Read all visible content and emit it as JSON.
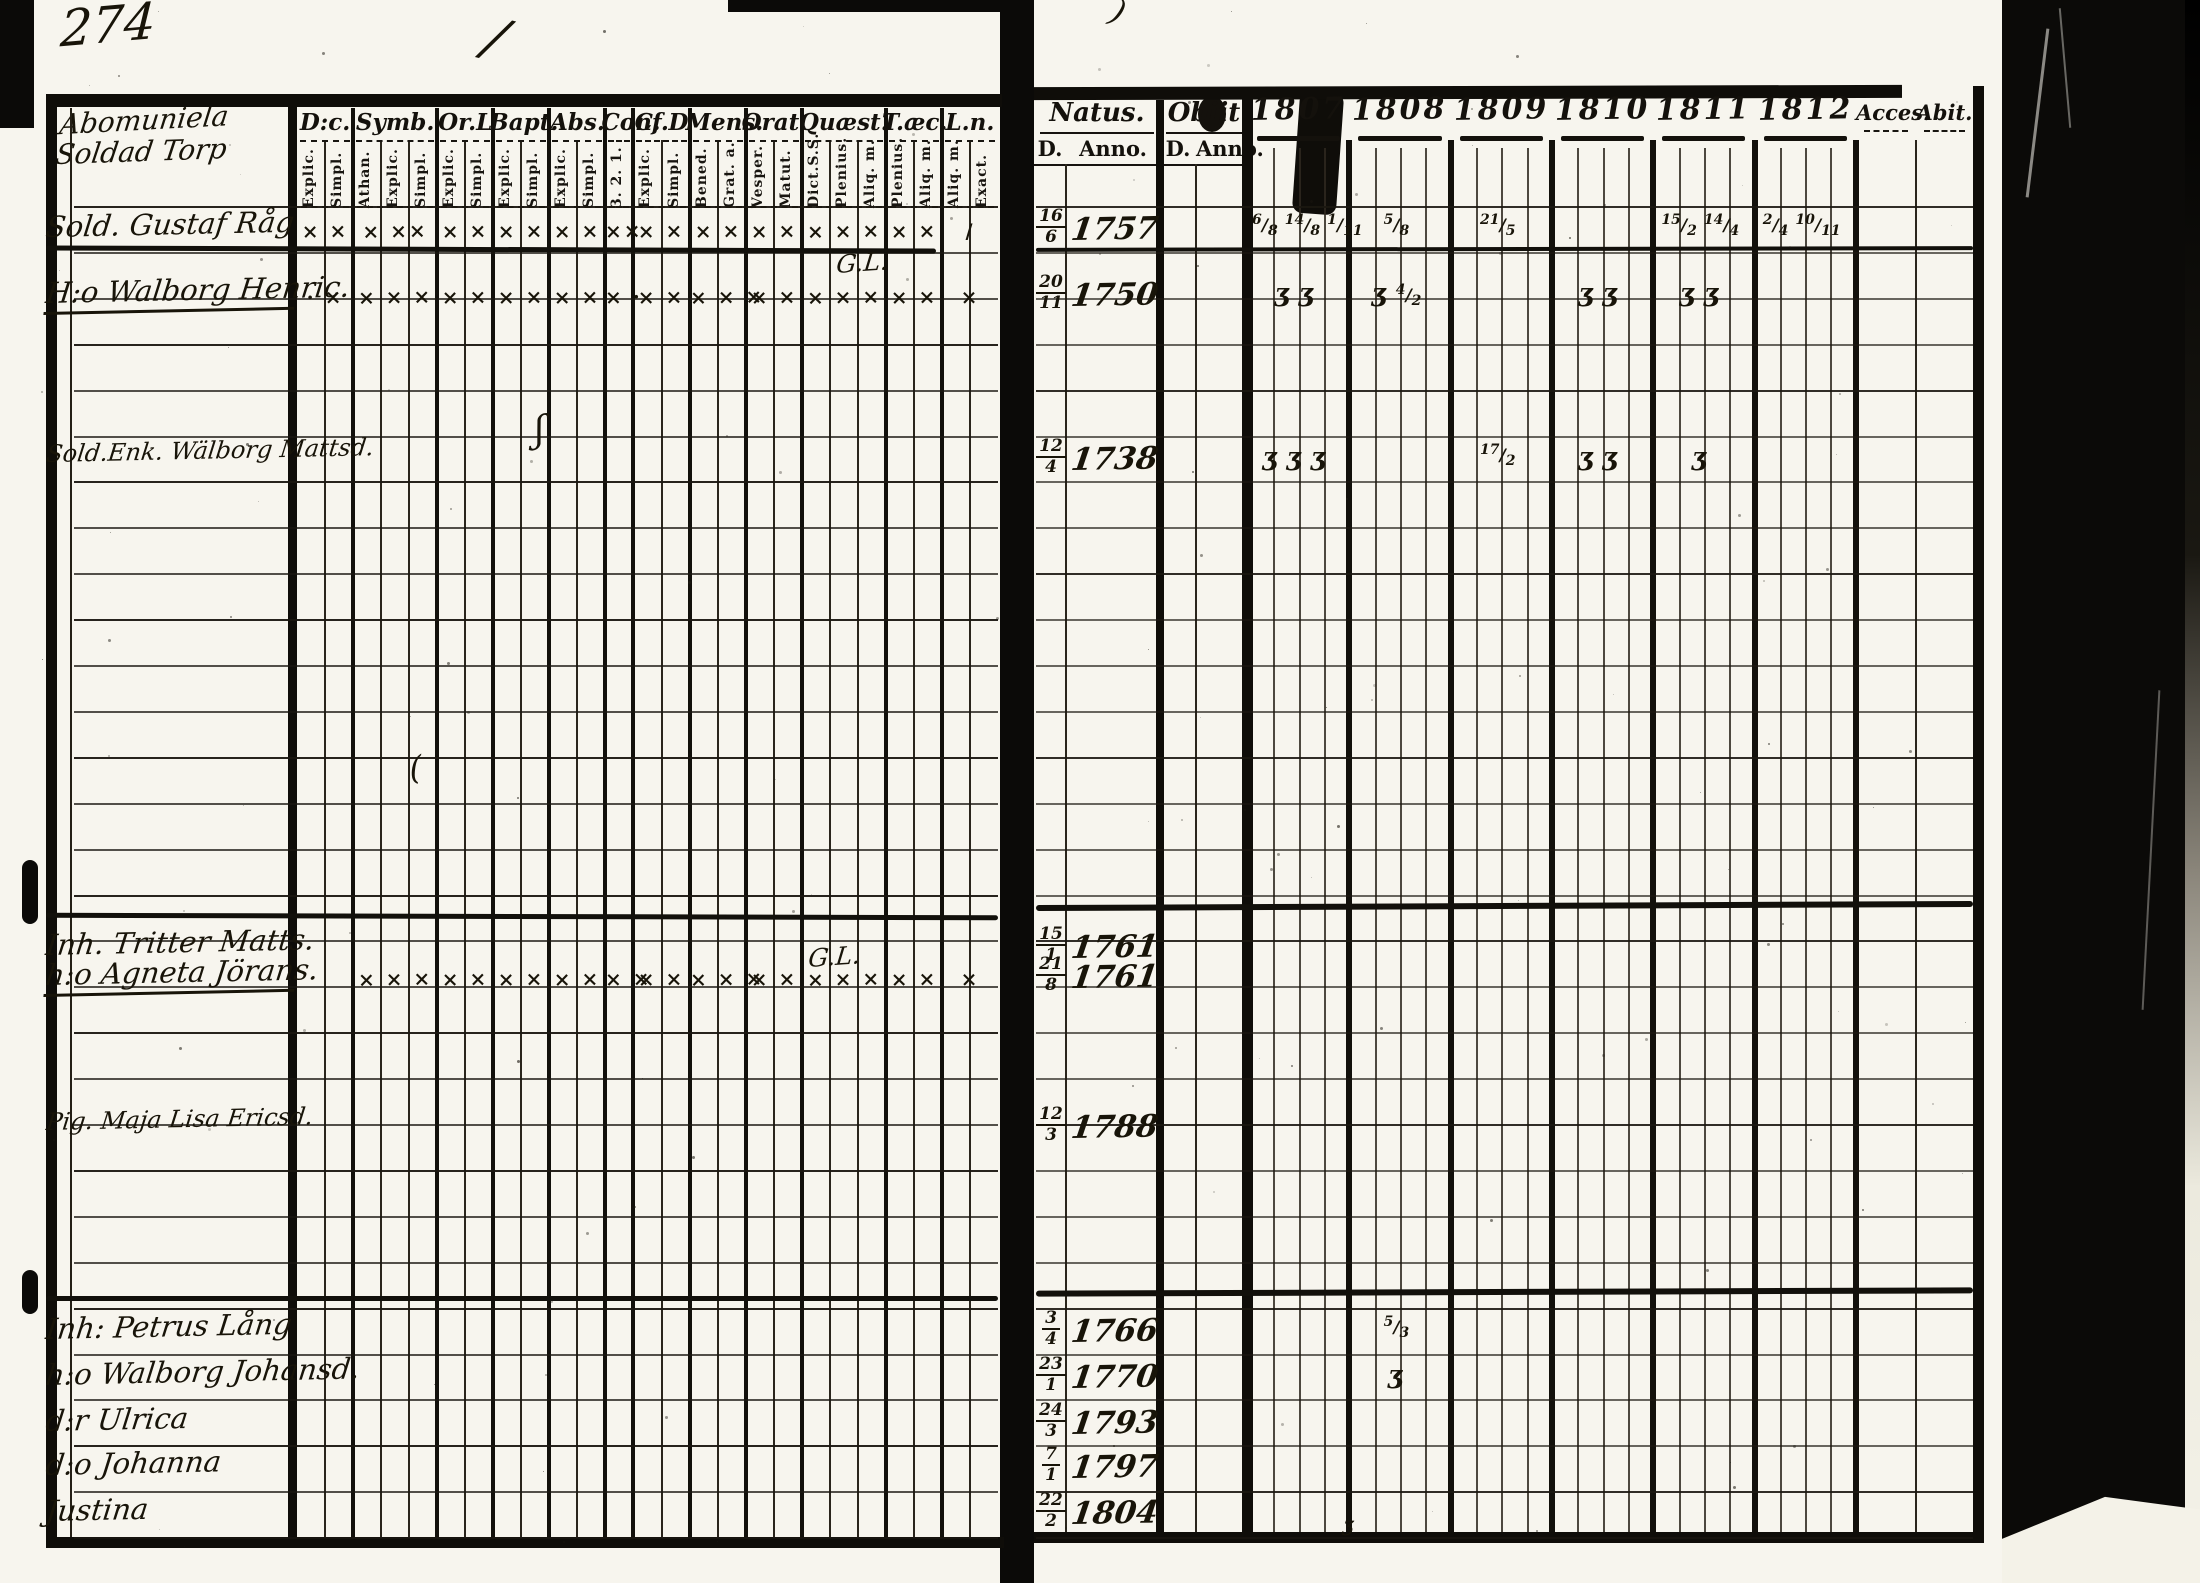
{
  "page_number": "274",
  "left_page": {
    "heading_lines": [
      "Abomuniela",
      "Soldad Torp"
    ],
    "column_groups": [
      {
        "label": "D:c.",
        "subs": [
          "Explic.",
          "Simpl."
        ]
      },
      {
        "label": "Symb.",
        "subs": [
          "Athan.",
          "Explic.",
          "Simpl."
        ]
      },
      {
        "label": "Or.L",
        "subs": [
          "Explic.",
          "Simpl."
        ]
      },
      {
        "label": "Bapt.",
        "subs": [
          "Explic.",
          "Simpl."
        ]
      },
      {
        "label": "Abs.",
        "subs": [
          "Explic.",
          "Simpl."
        ]
      },
      {
        "label": "Conf.",
        "subs": [
          "3. 2. 1."
        ]
      },
      {
        "label": "C. D",
        "subs": [
          "Explic.",
          "Simpl."
        ]
      },
      {
        "label": "Mens.",
        "subs": [
          "Bened.",
          "Grat. a."
        ]
      },
      {
        "label": "Orat.",
        "subs": [
          "Vesper.",
          "Matut."
        ]
      },
      {
        "label": "Quæst.",
        "subs": [
          "Dict.S.S.",
          "Plenius.",
          "Aliq. m."
        ]
      },
      {
        "label": "T.æc.",
        "subs": [
          "Plenius.",
          "Aliq. m."
        ]
      },
      {
        "label": "L.n.",
        "subs": [
          "Aliq. m.",
          "Exact."
        ]
      }
    ]
  },
  "right_page": {
    "natus_label": "Natus.",
    "obiit_label": "Obiit",
    "day_label": "D.",
    "anno_label": "Anno.",
    "years": [
      "1807",
      "1808",
      "1809",
      "1810",
      "1811",
      "1812"
    ],
    "acces_label": "Acces.",
    "abit_label": "Abit."
  },
  "persons": [
    {
      "name": "Sold. Gustaf Råg",
      "underline": false,
      "y": 210,
      "natus_d": "16/6",
      "natus_anno": "1757",
      "left_marks": [
        "× ×",
        "× ××",
        "× ×",
        "× ×",
        "× ×",
        "××",
        "× ×",
        "× ×",
        "× ×",
        "× × ×",
        "× ×",
        "/"
      ],
      "right_marks": {
        "1807": "6/8 14/8 1/11",
        "1808": "5/8",
        "1809": "21/5",
        "1811": "15/2 14/4",
        "1812": "2/4 10/11"
      }
    },
    {
      "name": "H:o Walborg Henric.",
      "underline": true,
      "y": 276,
      "natus_d": "20/11",
      "natus_anno": "1750",
      "left_marks": [
        "· ×",
        "× × ×",
        "× ×",
        "× ×",
        "× ×",
        "× ·",
        "× ×",
        "× × ×",
        "× ×",
        "× × ×",
        "× ×",
        "×"
      ],
      "right_marks": {
        "1807": "ʒ ʒ",
        "1808": "ʒ 4/2",
        "1810": "ʒ ʒ",
        "1811": "ʒ ʒ"
      },
      "note": {
        "text": "G.L.",
        "x": 838,
        "y": 250
      }
    },
    {
      "name": "Sold.Enk. Wälborg Mattsd.",
      "underline": false,
      "y": 440,
      "natus_d": "12/4",
      "natus_anno": "1738",
      "left_marks": [
        "",
        "",
        "",
        "",
        "",
        "",
        "",
        "",
        "",
        "",
        "",
        ""
      ],
      "right_marks": {
        "1807": "ʒ ʒ ʒ",
        "1809": "17/2",
        "1810": "ʒ ʒ",
        "1811": "ʒ"
      }
    },
    {
      "name": "Inh. Tritter Matts.",
      "underline": false,
      "y": 928,
      "natus_d": "15/1",
      "natus_anno": "1761",
      "left_marks": [
        "",
        "",
        "",
        "",
        "",
        "",
        "",
        "",
        "",
        "",
        "",
        ""
      ],
      "right_marks": {}
    },
    {
      "name": "h:o Agneta Jörans.",
      "underline": true,
      "y": 958,
      "natus_d": "21/8",
      "natus_anno": "1761",
      "left_marks": [
        "",
        "× × ×",
        "× ×",
        "× ×",
        "× ×",
        "× ×",
        "× ×",
        "× × ×",
        "× ×",
        "× × ×",
        "× ×",
        "×"
      ],
      "right_marks": {},
      "note": {
        "text": "G.L.",
        "x": 810,
        "y": 944
      }
    },
    {
      "name": "Pig. Maja Lisa Ericsd.",
      "underline": false,
      "y": 1108,
      "natus_d": "12/3",
      "natus_anno": "1788",
      "left_marks": [
        "",
        "",
        "",
        "",
        "",
        "",
        "",
        "",
        "",
        "",
        "",
        ""
      ],
      "right_marks": {}
    },
    {
      "name": "Inh: Petrus Lång",
      "underline": false,
      "y": 1312,
      "natus_d": "3/4",
      "natus_anno": "1766",
      "left_marks": [
        "",
        "",
        "",
        "",
        "",
        "",
        "",
        "",
        "",
        "",
        "",
        ""
      ],
      "right_marks": {
        "1808": "5/3"
      }
    },
    {
      "name": "h:o Walborg Johansd.",
      "underline": false,
      "y": 1358,
      "natus_d": "23/1",
      "natus_anno": "1770",
      "left_marks": [
        "",
        "",
        "",
        "",
        "",
        "",
        "",
        "",
        "",
        "",
        "",
        ""
      ],
      "right_marks": {
        "1808": "ʒ"
      }
    },
    {
      "name": "d:r Ulrica",
      "underline": false,
      "y": 1404,
      "natus_d": "24/3",
      "natus_anno": "1793",
      "left_marks": [
        "",
        "",
        "",
        "",
        "",
        "",
        "",
        "",
        "",
        "",
        "",
        ""
      ],
      "right_marks": {}
    },
    {
      "name": "d:o Johanna",
      "underline": false,
      "y": 1448,
      "natus_d": "7/1",
      "natus_anno": "1797",
      "left_marks": [
        "",
        "",
        "",
        "",
        "",
        "",
        "",
        "",
        "",
        "",
        "",
        ""
      ],
      "right_marks": {}
    },
    {
      "name": "Justina",
      "underline": false,
      "y": 1494,
      "natus_d": "22/2",
      "natus_anno": "1804",
      "left_marks": [
        "",
        "",
        "",
        "",
        "",
        "",
        "",
        "",
        "",
        "",
        "",
        ""
      ],
      "right_marks": {}
    }
  ],
  "annotations": [
    {
      "text": "/",
      "x": 498,
      "y": 6,
      "size": 54,
      "rot": 14
    },
    {
      "text": "ʃ",
      "x": 534,
      "y": 410,
      "size": 36,
      "rot": -8
    },
    {
      "text": "(",
      "x": 408,
      "y": 750,
      "size": 32,
      "rot": -10
    },
    {
      "text": ")",
      "x": 1120,
      "y": -8,
      "size": 32,
      "rot": 18
    },
    {
      "text": "ʒ",
      "x": 1344,
      "y": 1512,
      "size": 20,
      "rot": 0
    }
  ]
}
